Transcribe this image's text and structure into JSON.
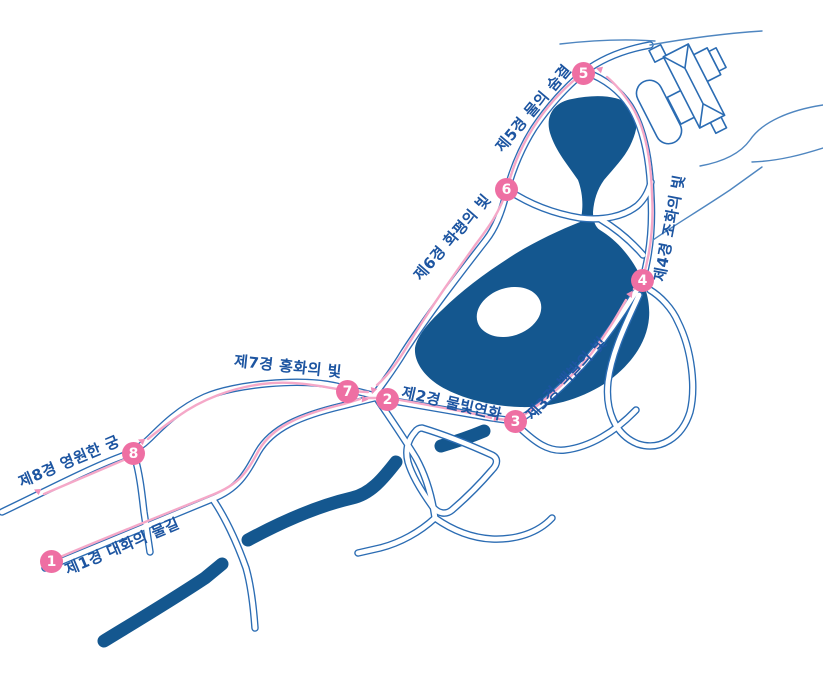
{
  "map": {
    "scenes": [
      {
        "number": "1",
        "label": "제1경 대화의 물길"
      },
      {
        "number": "2",
        "label": "제2경 물빛연화"
      },
      {
        "number": "3",
        "label": "제3경 백발의 빛"
      },
      {
        "number": "4",
        "label": "제4경 조화의 빛"
      },
      {
        "number": "5",
        "label": "제5경 물의 숨결"
      },
      {
        "number": "6",
        "label": "제6경 화평의 빛"
      },
      {
        "number": "7",
        "label": "제7경 홍화의 빛"
      },
      {
        "number": "8",
        "label": "제8경 영원한 궁"
      }
    ],
    "landmarks": [
      "palace-building-icon",
      "hall-building-icon",
      "lake",
      "island",
      "river",
      "stream-waves-icon"
    ],
    "colors": {
      "water": "#14578f",
      "road": "#2b6cb3",
      "route": "#f5a8c8",
      "route_arrow": "#f090bb",
      "marker": "#ee6fa3",
      "label_text": "#1d55a1",
      "background": "#ffffff"
    }
  }
}
